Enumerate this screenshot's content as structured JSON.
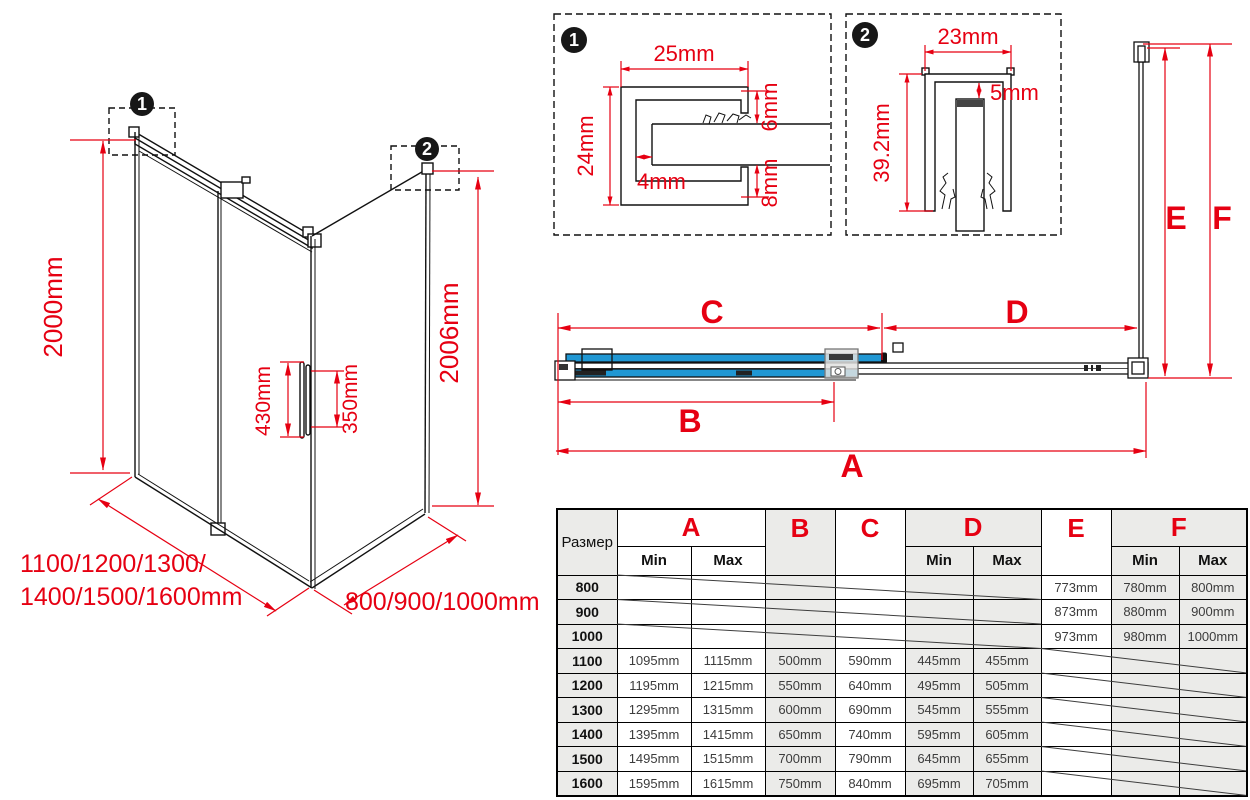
{
  "colors": {
    "dim_red": "#e60012",
    "glass_blue": "#2097d3",
    "line_black": "#111111",
    "table_gray": "#ebebe9"
  },
  "iso": {
    "badge1": "1",
    "badge2": "2",
    "height_left": "2000mm",
    "height_right": "2006mm",
    "handle_outer": "430mm",
    "handle_inner": "350mm",
    "width_label_line1": "1100/1200/1300/",
    "width_label_line2": "1400/1500/1600mm",
    "depth_label": "800/900/1000mm"
  },
  "detail1": {
    "badge": "1",
    "width_top": "25mm",
    "height_left": "24mm",
    "inset": "4mm",
    "gap_top_right": "6mm",
    "gap_bottom_right": "8mm"
  },
  "detail2": {
    "badge": "2",
    "width_top": "23mm",
    "gap_top": "5mm",
    "height_left": "39.2mm"
  },
  "plan": {
    "label_a": "A",
    "label_b": "B",
    "label_c": "C",
    "label_d": "D",
    "label_e": "E",
    "label_f": "F"
  },
  "table": {
    "size_header": "Размер",
    "sub_min": "Min",
    "sub_max": "Max",
    "columns": [
      "A",
      "B",
      "C",
      "D",
      "E",
      "F"
    ],
    "rows": [
      {
        "size": "800",
        "values": [
          null,
          null,
          null,
          null,
          null,
          null,
          "773mm",
          "780mm",
          "800mm"
        ]
      },
      {
        "size": "900",
        "values": [
          null,
          null,
          null,
          null,
          null,
          null,
          "873mm",
          "880mm",
          "900mm"
        ]
      },
      {
        "size": "1000",
        "values": [
          null,
          null,
          null,
          null,
          null,
          null,
          "973mm",
          "980mm",
          "1000mm"
        ]
      },
      {
        "size": "1100",
        "values": [
          "1095mm",
          "1115mm",
          "500mm",
          "590mm",
          "445mm",
          "455mm",
          null,
          null,
          null
        ]
      },
      {
        "size": "1200",
        "values": [
          "1195mm",
          "1215mm",
          "550mm",
          "640mm",
          "495mm",
          "505mm",
          null,
          null,
          null
        ]
      },
      {
        "size": "1300",
        "values": [
          "1295mm",
          "1315mm",
          "600mm",
          "690mm",
          "545mm",
          "555mm",
          null,
          null,
          null
        ]
      },
      {
        "size": "1400",
        "values": [
          "1395mm",
          "1415mm",
          "650mm",
          "740mm",
          "595mm",
          "605mm",
          null,
          null,
          null
        ]
      },
      {
        "size": "1500",
        "values": [
          "1495mm",
          "1515mm",
          "700mm",
          "790mm",
          "645mm",
          "655mm",
          null,
          null,
          null
        ]
      },
      {
        "size": "1600",
        "values": [
          "1595mm",
          "1615mm",
          "750mm",
          "840mm",
          "695mm",
          "705mm",
          null,
          null,
          null
        ]
      }
    ]
  }
}
